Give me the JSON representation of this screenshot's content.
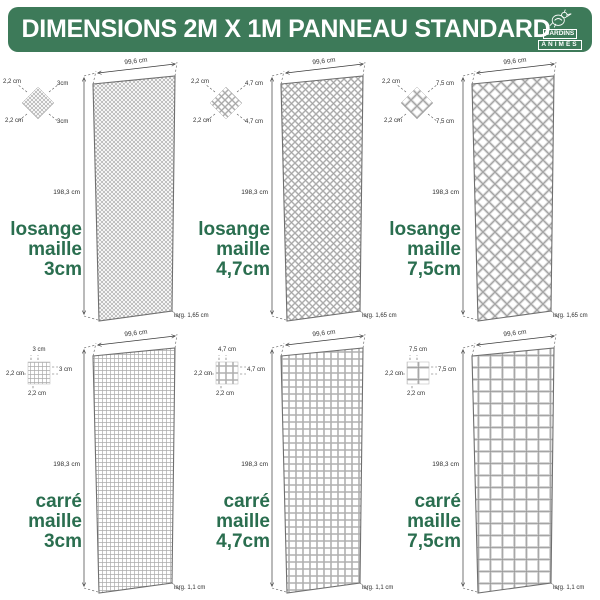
{
  "header": {
    "title": "DIMENSIONS 2M X 1M PANNEAU STANDARD",
    "logo": {
      "line1": "JARDINS",
      "line2": "ANIMÉS"
    }
  },
  "colors": {
    "header_green": "#3d7a59",
    "label_green": "#2a6e4f",
    "mesh_grey": "#a8a8a8"
  },
  "panels": [
    {
      "id": "losange-maille-3cm",
      "label1": "losange",
      "label2": "maille",
      "label3": "3cm",
      "width": "99,6 cm",
      "height": "198,3 cm",
      "thickness": "larg. 1,65 cm",
      "d1": "2,2 cm",
      "d2": "3cm",
      "d3": "2,2 cm",
      "d4": "3cm"
    },
    {
      "id": "losange-maille-47cm",
      "label1": "losange",
      "label2": "maille",
      "label3": "4,7cm",
      "width": "99,6 cm",
      "height": "198,3 cm",
      "thickness": "larg. 1,65 cm",
      "d1": "2,2 cm",
      "d2": "4,7 cm",
      "d3": "2,2 cm",
      "d4": "4,7 cm"
    },
    {
      "id": "losange-maille-75cm",
      "label1": "losange",
      "label2": "maille",
      "label3": "7,5cm",
      "width": "99,6 cm",
      "height": "198,3 cm",
      "thickness": "larg. 1,65 cm",
      "d1": "2,2 cm",
      "d2": "7,5 cm",
      "d3": "2,2 cm",
      "d4": "7,5 cm"
    },
    {
      "id": "carre-maille-3cm",
      "label1": "carré",
      "label2": "maille",
      "label3": "3cm",
      "width": "99,6 cm",
      "height": "198,3 cm",
      "thickness": "larg. 1,1 cm",
      "d1": "3 cm",
      "d2": "3 cm",
      "d3": "2,2 cm",
      "d4": "2,2 cm"
    },
    {
      "id": "carre-maille-47cm",
      "label1": "carré",
      "label2": "maille",
      "label3": "4,7cm",
      "width": "99,6 cm",
      "height": "198,3 cm",
      "thickness": "larg. 1,1 cm",
      "d1": "4,7 cm",
      "d2": "4,7 cm",
      "d3": "2,2 cm",
      "d4": "2,2 cm"
    },
    {
      "id": "carre-maille-75cm",
      "label1": "carré",
      "label2": "maille",
      "label3": "7,5cm",
      "width": "99,6 cm",
      "height": "198,3 cm",
      "thickness": "larg. 1,1 cm",
      "d1": "7,5 cm",
      "d2": "7,5 cm",
      "d3": "2,2 cm",
      "d4": "2,2 cm"
    }
  ]
}
